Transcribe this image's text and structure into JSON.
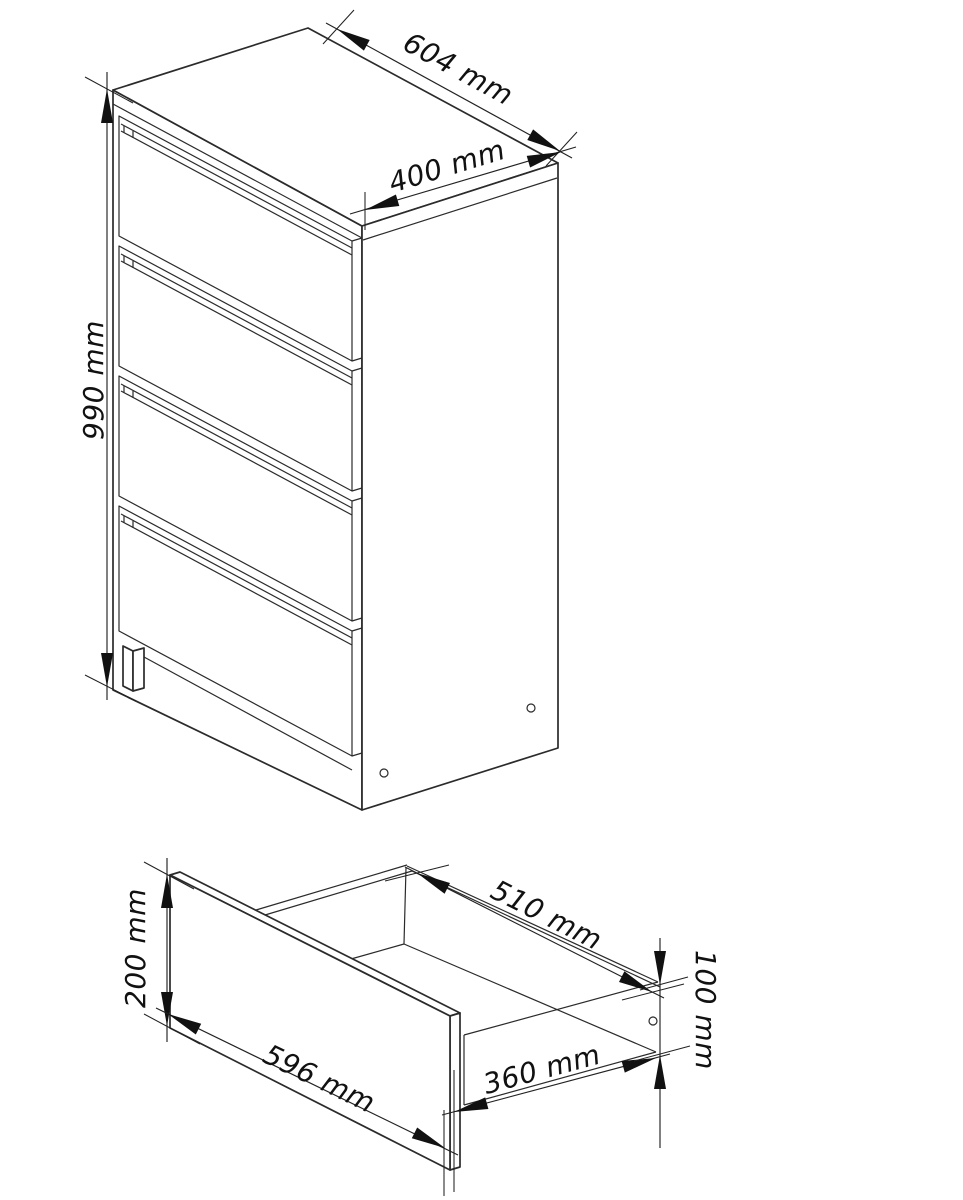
{
  "diagram": {
    "title": "chest-of-drawers-dimension-diagram",
    "background": "#ffffff",
    "line_color": "#2b2b2b",
    "views": {
      "dresser": {
        "name": "4-drawer chest isometric view",
        "drawer_count": 4,
        "dimensions": {
          "width": {
            "label": "604 mm",
            "value_mm": 604
          },
          "depth": {
            "label": "400 mm",
            "value_mm": 400
          },
          "height": {
            "label": "990 mm",
            "value_mm": 990
          }
        }
      },
      "drawer": {
        "name": "single drawer isometric detail",
        "dimensions": {
          "front_width": {
            "label": "596 mm",
            "value_mm": 596
          },
          "front_height": {
            "label": "200 mm",
            "value_mm": 200
          },
          "inner_width": {
            "label": "510 mm",
            "value_mm": 510
          },
          "inner_depth": {
            "label": "360 mm",
            "value_mm": 360
          },
          "side_height": {
            "label": "100 mm",
            "value_mm": 100
          }
        }
      }
    }
  }
}
